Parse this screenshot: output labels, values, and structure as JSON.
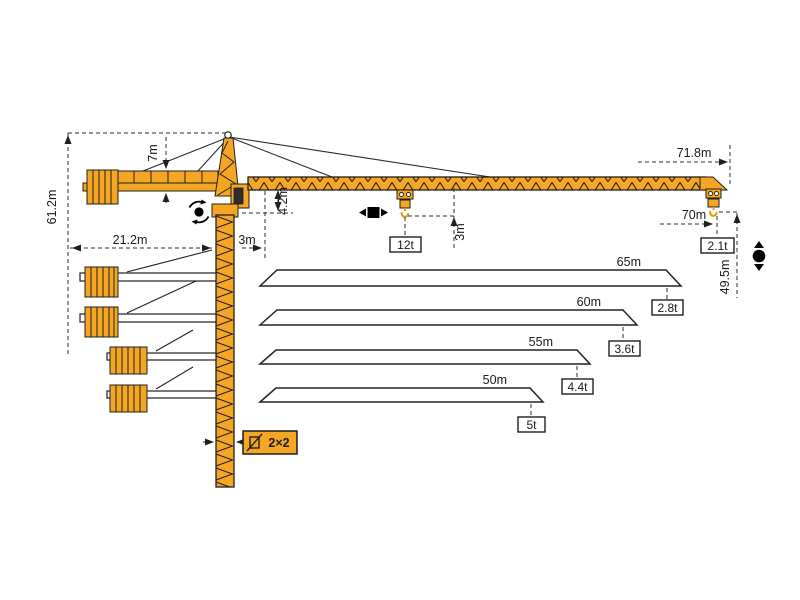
{
  "diagram_title": "tower-crane-working-range-diagram",
  "colors": {
    "crane_orange": "#F5A623",
    "outline": "#1F1F1F",
    "dimension_line": "#2B2B2B",
    "background": "#FFFFFF"
  },
  "dimensions": {
    "total_height": "61.2m",
    "tower_head_height": "7m",
    "counter_jib_radius": "21.2m",
    "min_radius": "3m",
    "jib_root_height": "4.2m",
    "hook_clearance": "3m",
    "max_hook_capacity": "12t",
    "max_radius": "71.8m",
    "tip_hook_radius": "70m",
    "tip_capacity": "2.1t",
    "hook_height": "49.5m",
    "mast_section": "2×2"
  },
  "jib_options": [
    {
      "length": "65m",
      "capacity": "2.8t"
    },
    {
      "length": "60m",
      "capacity": "3.6t"
    },
    {
      "length": "55m",
      "capacity": "4.4t"
    },
    {
      "length": "50m",
      "capacity": "5t"
    }
  ],
  "icons": {
    "slewing": "slewing-rotation",
    "trolley": "trolley-travel",
    "hoist": "hoist-up-down",
    "mast_section": "mast-cross-section"
  }
}
